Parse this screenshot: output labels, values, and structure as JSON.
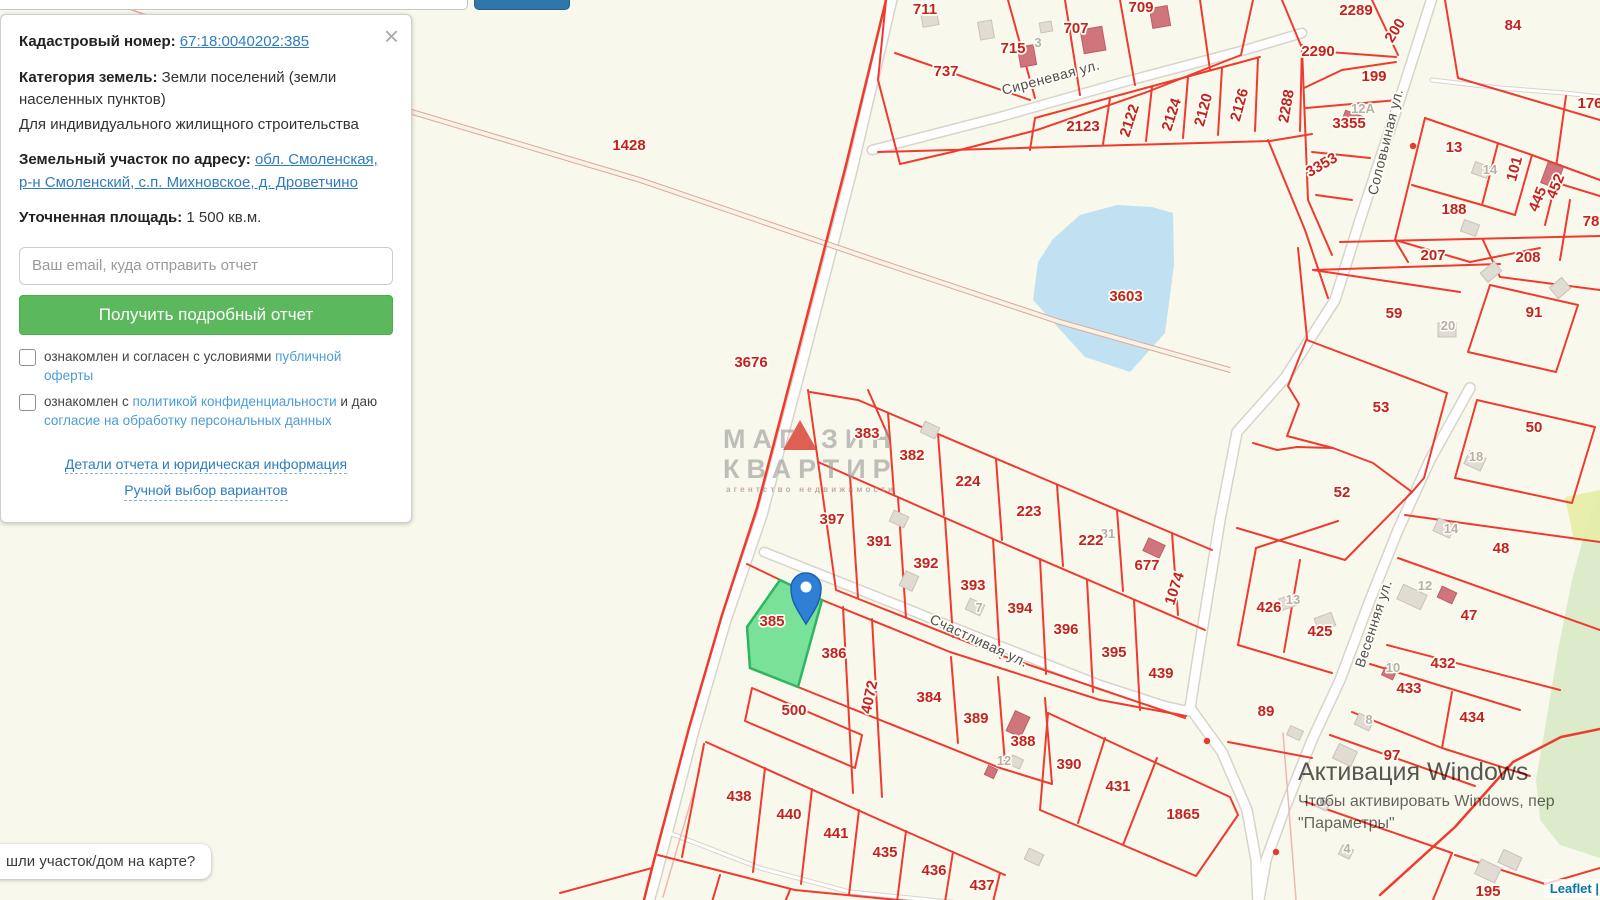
{
  "panel": {
    "close": "×",
    "cadastral_label": "Кадастровый номер:",
    "cadastral_number": "67:18:0040202:385",
    "category_label": "Категория земель:",
    "category_value": "Земли поселений (земли населенных пунктов)",
    "category_extra": "Для индивидуального жилищного строительства",
    "address_label": "Земельный участок по адресу:",
    "address_link": "обл. Смоленская, р-н Смоленский, с.п. Михновское, д. Дроветчино",
    "area_label": "Уточненная площадь:",
    "area_value": "1 500 кв.м.",
    "email_placeholder": "Ваш email, куда отправить отчет",
    "submit_label": "Получить подробный отчет",
    "agree1": {
      "pre": "ознакомлен и согласен с условиями ",
      "link": "публичной оферты"
    },
    "agree2": {
      "pre": "ознакомлен с ",
      "link1": "политикой конфиденциальности",
      "mid": " и даю ",
      "link2": "согласие на обработку персональных данных"
    },
    "footer_link1": "Детали отчета и юридическая информация",
    "footer_link2": "Ручной выбор вариантов"
  },
  "tooltip": {
    "text": "шли участок/дом на карте?"
  },
  "attribution": {
    "text": "Leaflet |"
  },
  "windows_watermark": {
    "line1": "Активация Windows",
    "line2": "Чтобы активировать Windows, пер",
    "line3": "\"Параметры\""
  },
  "map": {
    "selected_parcel": "385",
    "colors": {
      "background": "#f9f8ec",
      "parcel_line": "#ee3b2e",
      "parcel_label": "#c2241d",
      "selected_fill": "#63de8a",
      "selected_stroke": "#2eb563",
      "pond": "#bfe1f1",
      "forest": "#dcecca",
      "marker": "#2e7fd6"
    },
    "watermark": {
      "part1": "МАГ",
      "part2": "ЗИН",
      "line2": "КВАРТИР",
      "line3": "агентство недвижимости"
    },
    "street_labels": [
      {
        "t": "Сиреневая ул.",
        "x": 1052,
        "y": 82,
        "r": -15
      },
      {
        "t": "Соловьиная ул.",
        "x": 1390,
        "y": 143,
        "r": -76
      },
      {
        "t": "Счастливая ул.",
        "x": 977,
        "y": 645,
        "r": 25
      },
      {
        "t": "Весенняя ул.",
        "x": 1378,
        "y": 625,
        "r": -72
      }
    ],
    "parcel_labels": [
      {
        "t": "711",
        "x": 925,
        "y": 14
      },
      {
        "t": "737",
        "x": 946,
        "y": 76
      },
      {
        "t": "715",
        "x": 1013,
        "y": 53
      },
      {
        "t": "707",
        "x": 1076,
        "y": 33
      },
      {
        "t": "709",
        "x": 1141,
        "y": 12
      },
      {
        "t": "2123",
        "x": 1083,
        "y": 131
      },
      {
        "t": "2122",
        "x": 1134,
        "y": 122,
        "r": -72
      },
      {
        "t": "2124",
        "x": 1176,
        "y": 116,
        "r": -72
      },
      {
        "t": "2120",
        "x": 1208,
        "y": 111,
        "r": -75
      },
      {
        "t": "2126",
        "x": 1244,
        "y": 106,
        "r": -75
      },
      {
        "t": "2288",
        "x": 1291,
        "y": 107,
        "r": -80
      },
      {
        "t": "2289",
        "x": 1356,
        "y": 15
      },
      {
        "t": "2290",
        "x": 1318,
        "y": 56
      },
      {
        "t": "200",
        "x": 1399,
        "y": 33,
        "r": -58
      },
      {
        "t": "199",
        "x": 1374,
        "y": 81
      },
      {
        "t": "3355",
        "x": 1349,
        "y": 128
      },
      {
        "t": "3353",
        "x": 1324,
        "y": 169,
        "r": -30
      },
      {
        "t": "84",
        "x": 1513,
        "y": 30
      },
      {
        "t": "176",
        "x": 1590,
        "y": 108
      },
      {
        "t": "13",
        "x": 1454,
        "y": 152
      },
      {
        "t": "101",
        "x": 1519,
        "y": 170,
        "r": -75
      },
      {
        "t": "445",
        "x": 1542,
        "y": 201,
        "r": -68
      },
      {
        "t": "452",
        "x": 1560,
        "y": 188,
        "r": -68
      },
      {
        "t": "188",
        "x": 1454,
        "y": 214
      },
      {
        "t": "78",
        "x": 1591,
        "y": 226
      },
      {
        "t": "207",
        "x": 1433,
        "y": 260
      },
      {
        "t": "208",
        "x": 1528,
        "y": 262
      },
      {
        "t": "59",
        "x": 1394,
        "y": 318
      },
      {
        "t": "91",
        "x": 1534,
        "y": 317
      },
      {
        "t": "53",
        "x": 1381,
        "y": 412
      },
      {
        "t": "50",
        "x": 1534,
        "y": 432
      },
      {
        "t": "52",
        "x": 1342,
        "y": 497
      },
      {
        "t": "1428",
        "x": 629,
        "y": 150
      },
      {
        "t": "3676",
        "x": 751,
        "y": 367
      },
      {
        "t": "3603",
        "x": 1126,
        "y": 301
      },
      {
        "t": "383",
        "x": 867,
        "y": 438
      },
      {
        "t": "382",
        "x": 912,
        "y": 460
      },
      {
        "t": "224",
        "x": 968,
        "y": 486
      },
      {
        "t": "223",
        "x": 1029,
        "y": 516
      },
      {
        "t": "222",
        "x": 1091,
        "y": 545
      },
      {
        "t": "677",
        "x": 1147,
        "y": 570
      },
      {
        "t": "1074",
        "x": 1179,
        "y": 590,
        "r": -72
      },
      {
        "t": "397",
        "x": 832,
        "y": 524
      },
      {
        "t": "391",
        "x": 879,
        "y": 546
      },
      {
        "t": "392",
        "x": 926,
        "y": 568
      },
      {
        "t": "393",
        "x": 973,
        "y": 590
      },
      {
        "t": "394",
        "x": 1020,
        "y": 613
      },
      {
        "t": "396",
        "x": 1066,
        "y": 634
      },
      {
        "t": "395",
        "x": 1114,
        "y": 657
      },
      {
        "t": "439",
        "x": 1161,
        "y": 678
      },
      {
        "t": "426",
        "x": 1269,
        "y": 612
      },
      {
        "t": "425",
        "x": 1320,
        "y": 636
      },
      {
        "t": "48",
        "x": 1501,
        "y": 553
      },
      {
        "t": "47",
        "x": 1469,
        "y": 620
      },
      {
        "t": "432",
        "x": 1443,
        "y": 668
      },
      {
        "t": "433",
        "x": 1409,
        "y": 693
      },
      {
        "t": "434",
        "x": 1472,
        "y": 722
      },
      {
        "t": "89",
        "x": 1266,
        "y": 716
      },
      {
        "t": "97",
        "x": 1392,
        "y": 760
      },
      {
        "t": "385",
        "x": 772,
        "y": 626
      },
      {
        "t": "386",
        "x": 834,
        "y": 658
      },
      {
        "t": "500",
        "x": 794,
        "y": 715
      },
      {
        "t": "4072",
        "x": 874,
        "y": 698,
        "r": -78
      },
      {
        "t": "384",
        "x": 929,
        "y": 702
      },
      {
        "t": "389",
        "x": 976,
        "y": 723
      },
      {
        "t": "388",
        "x": 1023,
        "y": 746
      },
      {
        "t": "390",
        "x": 1069,
        "y": 769
      },
      {
        "t": "431",
        "x": 1118,
        "y": 791
      },
      {
        "t": "1865",
        "x": 1183,
        "y": 819
      },
      {
        "t": "438",
        "x": 739,
        "y": 801
      },
      {
        "t": "440",
        "x": 789,
        "y": 819
      },
      {
        "t": "441",
        "x": 836,
        "y": 838
      },
      {
        "t": "435",
        "x": 885,
        "y": 857
      },
      {
        "t": "436",
        "x": 934,
        "y": 875
      },
      {
        "t": "437",
        "x": 982,
        "y": 890
      },
      {
        "t": "195",
        "x": 1488,
        "y": 896
      }
    ],
    "house_labels": [
      {
        "t": "3",
        "x": 1038,
        "y": 47
      },
      {
        "t": "12А",
        "x": 1363,
        "y": 113
      },
      {
        "t": "14",
        "x": 1490,
        "y": 174
      },
      {
        "t": "31",
        "x": 1108,
        "y": 538
      },
      {
        "t": "20",
        "x": 1448,
        "y": 330
      },
      {
        "t": "18",
        "x": 1476,
        "y": 461
      },
      {
        "t": "14",
        "x": 1451,
        "y": 533
      },
      {
        "t": "13",
        "x": 1293,
        "y": 604
      },
      {
        "t": "12",
        "x": 1425,
        "y": 590
      },
      {
        "t": "10",
        "x": 1393,
        "y": 672
      },
      {
        "t": "8",
        "x": 1369,
        "y": 724
      },
      {
        "t": "7",
        "x": 979,
        "y": 612
      },
      {
        "t": "12",
        "x": 1004,
        "y": 765
      },
      {
        "t": "6",
        "x": 1323,
        "y": 806
      },
      {
        "t": "4",
        "x": 1347,
        "y": 853
      }
    ],
    "markers_red": [
      {
        "x": 1413,
        "y": 146
      },
      {
        "x": 1207,
        "y": 741
      },
      {
        "x": 1276,
        "y": 852
      }
    ]
  }
}
